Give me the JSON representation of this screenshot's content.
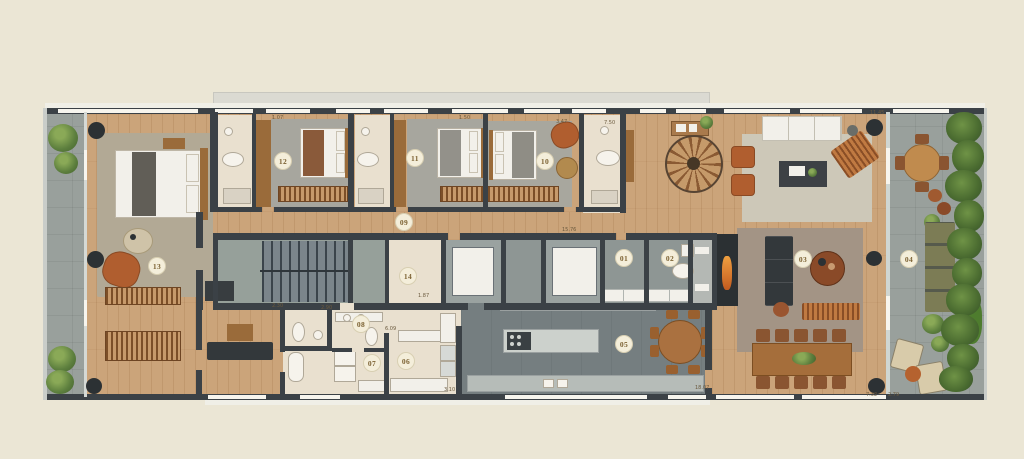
{
  "image_type": "architectural floor plan (penthouse level, top view)",
  "colors": {
    "background": "#ebe6d5",
    "walls": "#3b4146",
    "wood_floor": "#cba47a",
    "terrace_floor": "#99a09c",
    "bathroom_floor": "#e9e0cf",
    "kitchen_floor": "#757e80",
    "badge_background": "#f4eeda",
    "badge_text": "#7c6233",
    "greenery": "#5d7f3e",
    "accent_terracotta": "#b05e2f"
  },
  "badges": [
    {
      "id": "01"
    },
    {
      "id": "02"
    },
    {
      "id": "03"
    },
    {
      "id": "04"
    },
    {
      "id": "05"
    },
    {
      "id": "06"
    },
    {
      "id": "07"
    },
    {
      "id": "08"
    },
    {
      "id": "09"
    },
    {
      "id": "10"
    },
    {
      "id": "11"
    },
    {
      "id": "12"
    },
    {
      "id": "13"
    },
    {
      "id": "14"
    }
  ],
  "dimensions": [
    {
      "t": "1.07"
    },
    {
      "t": "1.50"
    },
    {
      "t": "3.47"
    },
    {
      "t": "7.50"
    },
    {
      "t": "11.45"
    },
    {
      "t": "15.76"
    },
    {
      "t": "2.30"
    },
    {
      "t": "2.90"
    },
    {
      "t": "1.87"
    },
    {
      "t": "6.09"
    },
    {
      "t": "3.10"
    },
    {
      "t": "18.07"
    },
    {
      "t": "7.32"
    },
    {
      "t": "2.79"
    }
  ]
}
